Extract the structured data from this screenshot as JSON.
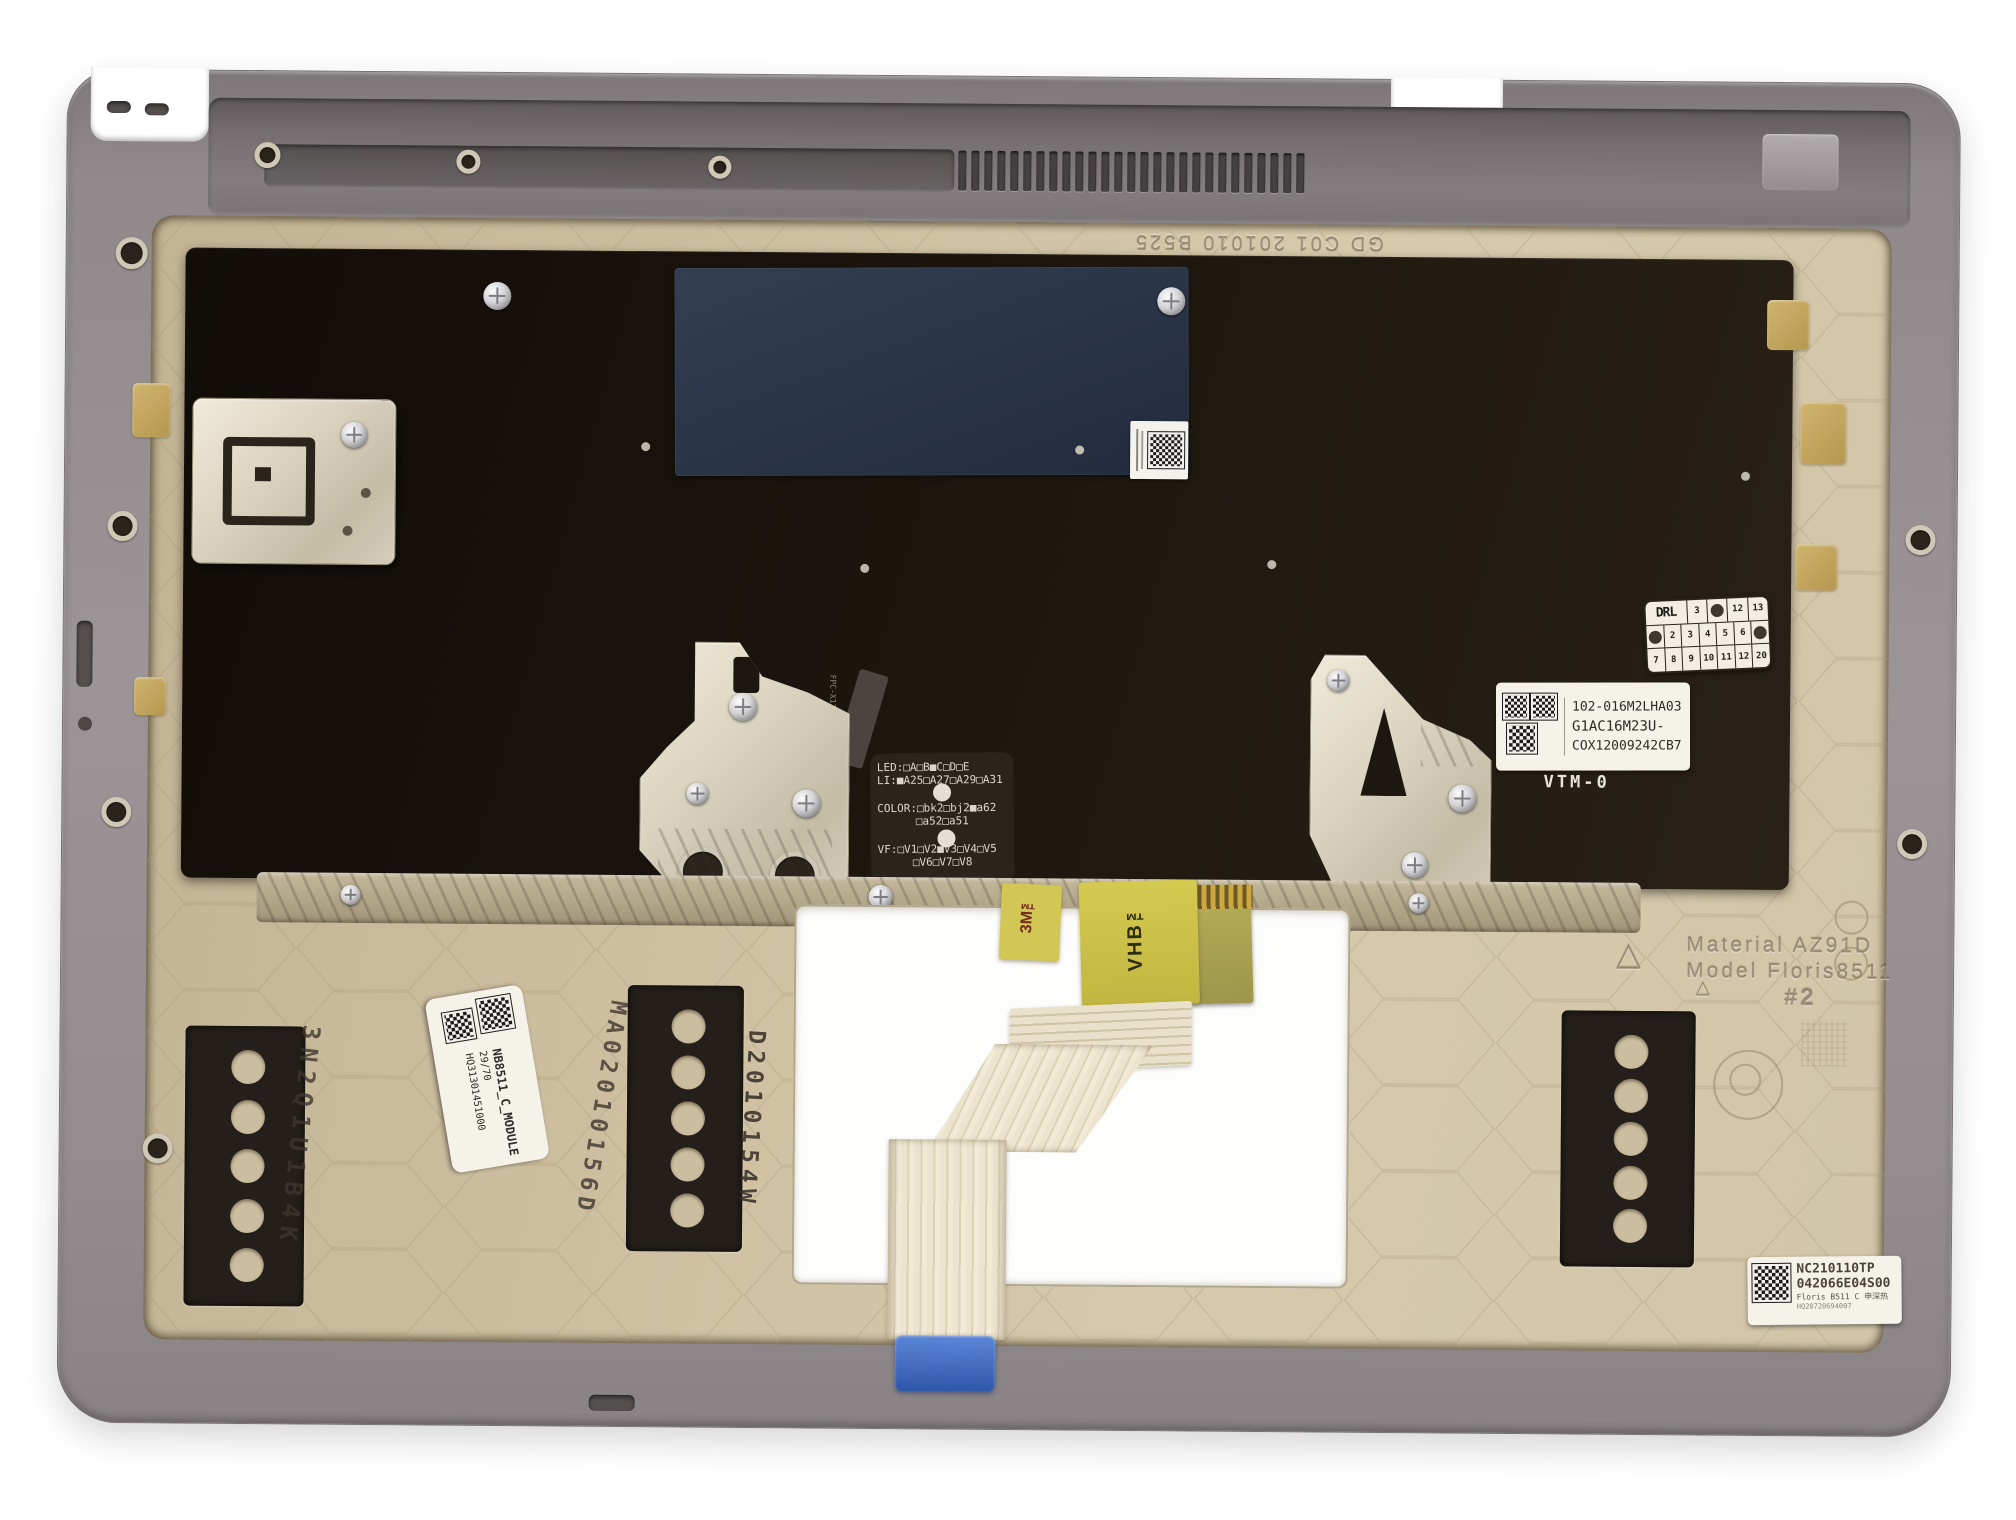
{
  "scene": {
    "description": "Inside view of a laptop top-case / palmrest assembly: gray magnesium shell, beige honeycomb deck, black keyboard backplate with service stickers, metal brackets, foam pads and an FFC ribbon cable through the touchpad cutout",
    "background": "#ffffff"
  },
  "colors": {
    "shell_gray": "#928c8e",
    "deck_beige": "#cfc1a3",
    "keyboard_plate": "#1d1712",
    "sticker_navy": "#2b3547",
    "tape_yellow": "#ccc14e",
    "ribbon_cream": "#eae2cd",
    "connector_blue": "#3c64b9",
    "foam_black": "#241f1a",
    "felt_gold": "#c6ad67",
    "bracket_metal": "#ded7c5"
  },
  "shell": {
    "vent_slot_count": 27
  },
  "pads": {
    "hole_count": 5
  },
  "labels": {
    "part_label": {
      "l1": "102-016M2LHA03",
      "l2": "G1AC16M23U-",
      "l3": "COX12009242CB7"
    },
    "vtm": "VTM-0",
    "led_patch": {
      "l1": "LED:□A□B■C□D□E",
      "l2": "LI:■A25□A27□A29□A31",
      "l3": "COLOR:□bk2□bj2■a62",
      "l4": "□a52□a51",
      "l5": "VF:□V1□V2■V3□V4□V5",
      "l6": "□V6□V7□V8"
    },
    "fpc_tail": "FPC-X11",
    "matrix": {
      "r1": [
        "DRL",
        "3",
        "12",
        "13"
      ],
      "r2": [
        "2",
        "3",
        "4",
        "5",
        "6"
      ],
      "r3": [
        "7",
        "8",
        "9",
        "10",
        "11",
        "12",
        "20"
      ]
    },
    "top_emboss": "GD C01 201010 B525",
    "mold": {
      "l1": "Material AZ91D",
      "l2": "Model Floris8511",
      "num": "#2"
    },
    "tape_3m": "3M™",
    "tape_vhb": "VHB™",
    "stamps": {
      "left": "3N2Q1U1B4K",
      "mid": "MA02010156D",
      "right": "D2010154W"
    },
    "module_label": {
      "l1": "NB8511_C_MODULE",
      "l2": "29/70",
      "l3": "HQ31301451000"
    },
    "br_label": {
      "l1": "NC210110TP",
      "l2": "042066E04S00",
      "l3": "Floris B511 C 申深热",
      "l4": "HQ20720694007"
    }
  }
}
